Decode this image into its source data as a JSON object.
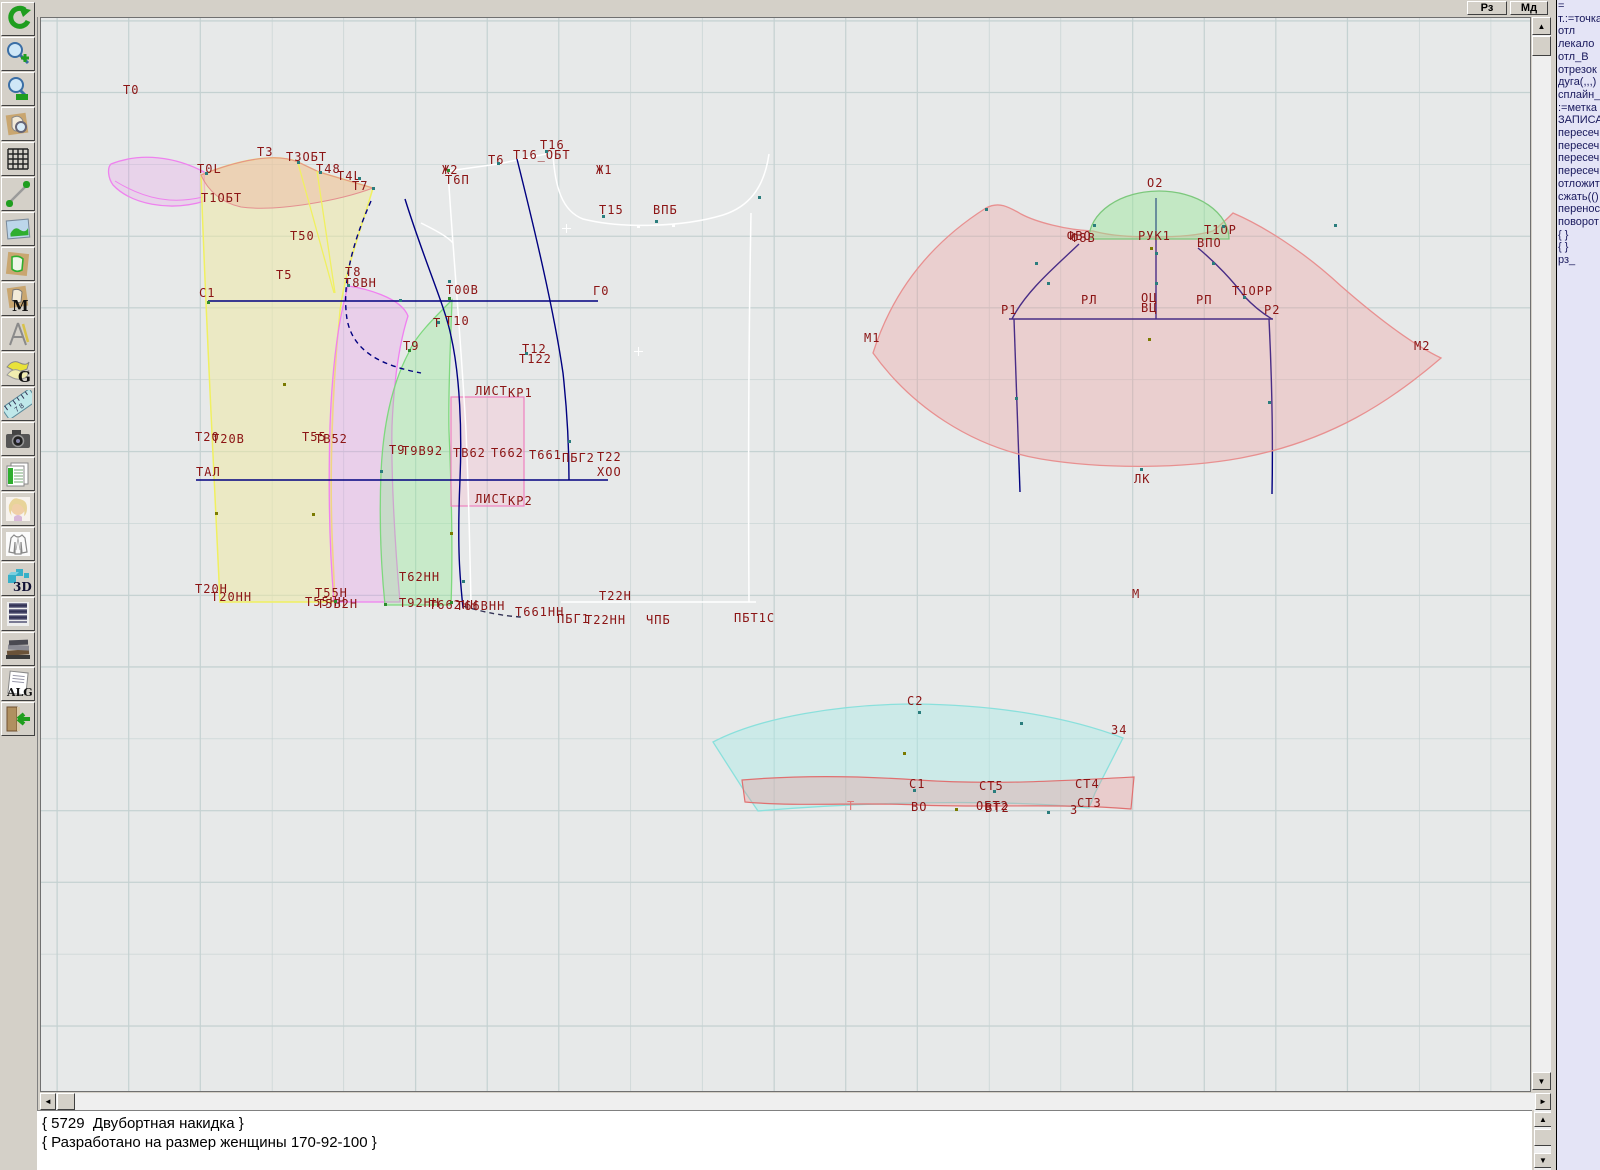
{
  "window": {
    "app_type": "pattern-cad"
  },
  "topbar": {
    "buttons": [
      {
        "id": "rz",
        "label": "Рз"
      },
      {
        "id": "md",
        "label": "Мд"
      }
    ]
  },
  "toolbar": {
    "icons": [
      "undo-icon",
      "zoom-in-icon",
      "zoom-out-icon",
      "pattern-preview-icon",
      "grid-icon",
      "measure-line-icon",
      "image-icon",
      "pattern-piece-icon",
      "pattern-m-icon",
      "drafting-compass-icon",
      "pattern-g-icon",
      "ruler-icon",
      "camera-icon",
      "spreadsheet-icon",
      "portrait-icon",
      "garment-sketch-icon",
      "3d-icon",
      "document-list-icon",
      "books-icon",
      "alg-document-icon",
      "exit-icon"
    ]
  },
  "right_panel": {
    "lines": [
      "=",
      "т.:=точка",
      "отл",
      "лекало",
      "отл_В",
      "отрезок",
      "дуга(,,,)",
      "сплайн_",
      ":=метка",
      "ЗАПИСА",
      "пересеч",
      "пересеч",
      "пересеч",
      "пересеч",
      "отложит",
      "сжать(()",
      "перенос",
      "поворот",
      "{ }",
      "{ }",
      "рз_"
    ]
  },
  "console": {
    "lines": [
      "{ 5729  Двубортная накидка }",
      "{ Разработано на размер женщины 170-92-100 }"
    ]
  },
  "canvas": {
    "colors": {
      "label": "#8b1414",
      "teal": "#2a7d7d",
      "green": "#2e8b2e",
      "olive": "#7a7a00",
      "pink": "#e07878",
      "navy": "#000080"
    },
    "labels": [
      {
        "t": "Т0",
        "x": 122,
        "y": 84
      },
      {
        "t": "Т3",
        "x": 256,
        "y": 146
      },
      {
        "t": "Т3ОБТ",
        "x": 285,
        "y": 151
      },
      {
        "t": "Т0L",
        "x": 196,
        "y": 163
      },
      {
        "t": "Т1ОБТ",
        "x": 200,
        "y": 192
      },
      {
        "t": "Т48",
        "x": 315,
        "y": 163
      },
      {
        "t": "Т4L",
        "x": 336,
        "y": 170
      },
      {
        "t": "Т7",
        "x": 351,
        "y": 180
      },
      {
        "t": "Т50",
        "x": 289,
        "y": 230
      },
      {
        "t": "Т5",
        "x": 275,
        "y": 269
      },
      {
        "t": "Т8",
        "x": 344,
        "y": 266
      },
      {
        "t": "Т8ВН",
        "x": 343,
        "y": 277
      },
      {
        "t": "С1",
        "x": 198,
        "y": 287
      },
      {
        "t": "Т00В",
        "x": 445,
        "y": 284
      },
      {
        "t": "Г0",
        "x": 592,
        "y": 285
      },
      {
        "t": "Т",
        "x": 432,
        "y": 317
      },
      {
        "t": "Т10",
        "x": 444,
        "y": 315
      },
      {
        "t": "Т9",
        "x": 402,
        "y": 340
      },
      {
        "t": "Т12",
        "x": 521,
        "y": 343
      },
      {
        "t": "Т122",
        "x": 518,
        "y": 353
      },
      {
        "t": "Ж2",
        "x": 441,
        "y": 164
      },
      {
        "t": "Т6П",
        "x": 444,
        "y": 174
      },
      {
        "t": "Т6",
        "x": 487,
        "y": 154
      },
      {
        "t": "Т16",
        "x": 539,
        "y": 139
      },
      {
        "t": "Т16_ОБТ",
        "x": 512,
        "y": 149
      },
      {
        "t": "Ж1",
        "x": 595,
        "y": 164
      },
      {
        "t": "Т15",
        "x": 598,
        "y": 204
      },
      {
        "t": "ВПБ",
        "x": 652,
        "y": 204
      },
      {
        "t": "ЛИСТ",
        "x": 474,
        "y": 385
      },
      {
        "t": "КР1",
        "x": 507,
        "y": 387
      },
      {
        "t": "ЛИСТ",
        "x": 474,
        "y": 493
      },
      {
        "t": "КР2",
        "x": 507,
        "y": 495
      },
      {
        "t": "Т20",
        "x": 194,
        "y": 431
      },
      {
        "t": "Т20В",
        "x": 211,
        "y": 433
      },
      {
        "t": "Т55",
        "x": 301,
        "y": 431
      },
      {
        "t": "ТВ52",
        "x": 314,
        "y": 433
      },
      {
        "t": "Т9",
        "x": 388,
        "y": 444
      },
      {
        "t": "Т9В92",
        "x": 401,
        "y": 445
      },
      {
        "t": "ТВ62",
        "x": 452,
        "y": 447
      },
      {
        "t": "Т662",
        "x": 490,
        "y": 447
      },
      {
        "t": "Т661",
        "x": 528,
        "y": 449
      },
      {
        "t": "ТАЛ",
        "x": 195,
        "y": 466
      },
      {
        "t": "ПБГ2",
        "x": 561,
        "y": 452
      },
      {
        "t": "Т22",
        "x": 596,
        "y": 451
      },
      {
        "t": "ХОО",
        "x": 596,
        "y": 466
      },
      {
        "t": "Т20Н",
        "x": 194,
        "y": 583
      },
      {
        "t": "Т20НН",
        "x": 210,
        "y": 591
      },
      {
        "t": "Т55Н",
        "x": 314,
        "y": 587
      },
      {
        "t": "Т55НН",
        "x": 304,
        "y": 596
      },
      {
        "t": "Т5В2Н",
        "x": 316,
        "y": 598
      },
      {
        "t": "Т62НН",
        "x": 398,
        "y": 571
      },
      {
        "t": "Т92НН",
        "x": 398,
        "y": 597
      },
      {
        "t": "Т662НН",
        "x": 428,
        "y": 599
      },
      {
        "t": "Т66ВНН",
        "x": 455,
        "y": 600
      },
      {
        "t": "Т661НН",
        "x": 514,
        "y": 606
      },
      {
        "t": "Т22Н",
        "x": 598,
        "y": 590
      },
      {
        "t": "ПБГ1",
        "x": 556,
        "y": 613
      },
      {
        "t": "Т22НН",
        "x": 584,
        "y": 614
      },
      {
        "t": "ЧПБ",
        "x": 645,
        "y": 614
      },
      {
        "t": "ПБТ1С",
        "x": 733,
        "y": 612
      },
      {
        "t": "О2",
        "x": 1146,
        "y": 177
      },
      {
        "t": "ФВО",
        "x": 1066,
        "y": 230
      },
      {
        "t": "Ф8В",
        "x": 1070,
        "y": 232
      },
      {
        "t": "РУК1",
        "x": 1137,
        "y": 230
      },
      {
        "t": "Т1ОР",
        "x": 1203,
        "y": 224
      },
      {
        "t": "ВПО",
        "x": 1196,
        "y": 237
      },
      {
        "t": "РЛ",
        "x": 1080,
        "y": 294
      },
      {
        "t": "ОЦ",
        "x": 1140,
        "y": 292
      },
      {
        "t": "ВЦ",
        "x": 1140,
        "y": 302
      },
      {
        "t": "РП",
        "x": 1195,
        "y": 294
      },
      {
        "t": "Т1ОРР",
        "x": 1231,
        "y": 285
      },
      {
        "t": "Р1",
        "x": 1000,
        "y": 304
      },
      {
        "t": "Р2",
        "x": 1263,
        "y": 304
      },
      {
        "t": "М1",
        "x": 863,
        "y": 332
      },
      {
        "t": "М2",
        "x": 1413,
        "y": 340
      },
      {
        "t": "ЛК",
        "x": 1133,
        "y": 473
      },
      {
        "t": "М",
        "x": 1131,
        "y": 588
      },
      {
        "t": "С2",
        "x": 906,
        "y": 695
      },
      {
        "t": "З4",
        "x": 1110,
        "y": 724
      },
      {
        "t": "С1",
        "x": 908,
        "y": 778
      },
      {
        "t": "СТ5",
        "x": 978,
        "y": 780
      },
      {
        "t": "СТ4",
        "x": 1074,
        "y": 778
      },
      {
        "t": "СТ3",
        "x": 1076,
        "y": 797
      },
      {
        "t": "ВО",
        "x": 910,
        "y": 801
      },
      {
        "t": "ОБТ2",
        "x": 975,
        "y": 800
      },
      {
        "t": "ВТ2",
        "x": 984,
        "y": 802
      },
      {
        "t": "З",
        "x": 1069,
        "y": 804
      },
      {
        "t": "Т",
        "x": 846,
        "y": 800,
        "c": "pink"
      }
    ],
    "points": [
      {
        "x": 205,
        "y": 172,
        "c": "teal"
      },
      {
        "x": 297,
        "y": 161,
        "c": "teal"
      },
      {
        "x": 319,
        "y": 171,
        "c": "teal"
      },
      {
        "x": 358,
        "y": 177,
        "c": "teal"
      },
      {
        "x": 372,
        "y": 187,
        "c": "teal"
      },
      {
        "x": 347,
        "y": 284,
        "c": "teal"
      },
      {
        "x": 399,
        "y": 299,
        "c": "teal"
      },
      {
        "x": 448,
        "y": 297,
        "c": "green"
      },
      {
        "x": 448,
        "y": 280,
        "c": "teal"
      },
      {
        "x": 437,
        "y": 321,
        "c": "teal"
      },
      {
        "x": 408,
        "y": 349,
        "c": "green"
      },
      {
        "x": 380,
        "y": 470,
        "c": "teal"
      },
      {
        "x": 462,
        "y": 580,
        "c": "teal"
      },
      {
        "x": 497,
        "y": 162,
        "c": "teal"
      },
      {
        "x": 545,
        "y": 150,
        "c": "teal"
      },
      {
        "x": 602,
        "y": 215,
        "c": "teal"
      },
      {
        "x": 655,
        "y": 220,
        "c": "teal"
      },
      {
        "x": 758,
        "y": 196,
        "c": "teal"
      },
      {
        "x": 568,
        "y": 440,
        "c": "teal"
      },
      {
        "x": 525,
        "y": 352,
        "c": "teal"
      },
      {
        "x": 207,
        "y": 301,
        "c": "green"
      },
      {
        "x": 334,
        "y": 600,
        "c": "green"
      },
      {
        "x": 384,
        "y": 603,
        "c": "green"
      },
      {
        "x": 450,
        "y": 601,
        "c": "green"
      },
      {
        "x": 447,
        "y": 169,
        "c": "green"
      },
      {
        "x": 283,
        "y": 383,
        "c": "olive"
      },
      {
        "x": 215,
        "y": 512,
        "c": "olive"
      },
      {
        "x": 312,
        "y": 513,
        "c": "olive"
      },
      {
        "x": 450,
        "y": 532,
        "c": "olive"
      },
      {
        "x": 1148,
        "y": 338,
        "c": "olive"
      },
      {
        "x": 1150,
        "y": 247,
        "c": "olive"
      },
      {
        "x": 903,
        "y": 752,
        "c": "olive"
      },
      {
        "x": 955,
        "y": 808,
        "c": "olive"
      },
      {
        "x": 985,
        "y": 208,
        "c": "teal"
      },
      {
        "x": 1093,
        "y": 224,
        "c": "teal"
      },
      {
        "x": 1222,
        "y": 225,
        "c": "teal"
      },
      {
        "x": 1155,
        "y": 252,
        "c": "teal"
      },
      {
        "x": 1155,
        "y": 282,
        "c": "teal"
      },
      {
        "x": 1047,
        "y": 282,
        "c": "teal"
      },
      {
        "x": 1243,
        "y": 296,
        "c": "teal"
      },
      {
        "x": 1015,
        "y": 397,
        "c": "teal"
      },
      {
        "x": 1268,
        "y": 401,
        "c": "teal"
      },
      {
        "x": 1334,
        "y": 224,
        "c": "teal"
      },
      {
        "x": 1140,
        "y": 468,
        "c": "teal"
      },
      {
        "x": 1035,
        "y": 262,
        "c": "teal"
      },
      {
        "x": 1212,
        "y": 262,
        "c": "teal"
      },
      {
        "x": 918,
        "y": 711,
        "c": "teal"
      },
      {
        "x": 1020,
        "y": 722,
        "c": "teal"
      },
      {
        "x": 913,
        "y": 789,
        "c": "teal"
      },
      {
        "x": 993,
        "y": 790,
        "c": "teal"
      },
      {
        "x": 1047,
        "y": 811,
        "c": "teal"
      },
      {
        "x": 637,
        "y": 225,
        "c": "white"
      },
      {
        "x": 672,
        "y": 224,
        "c": "white"
      }
    ],
    "crosses": [
      {
        "x": 565,
        "y": 227
      },
      {
        "x": 637,
        "y": 350
      }
    ]
  }
}
